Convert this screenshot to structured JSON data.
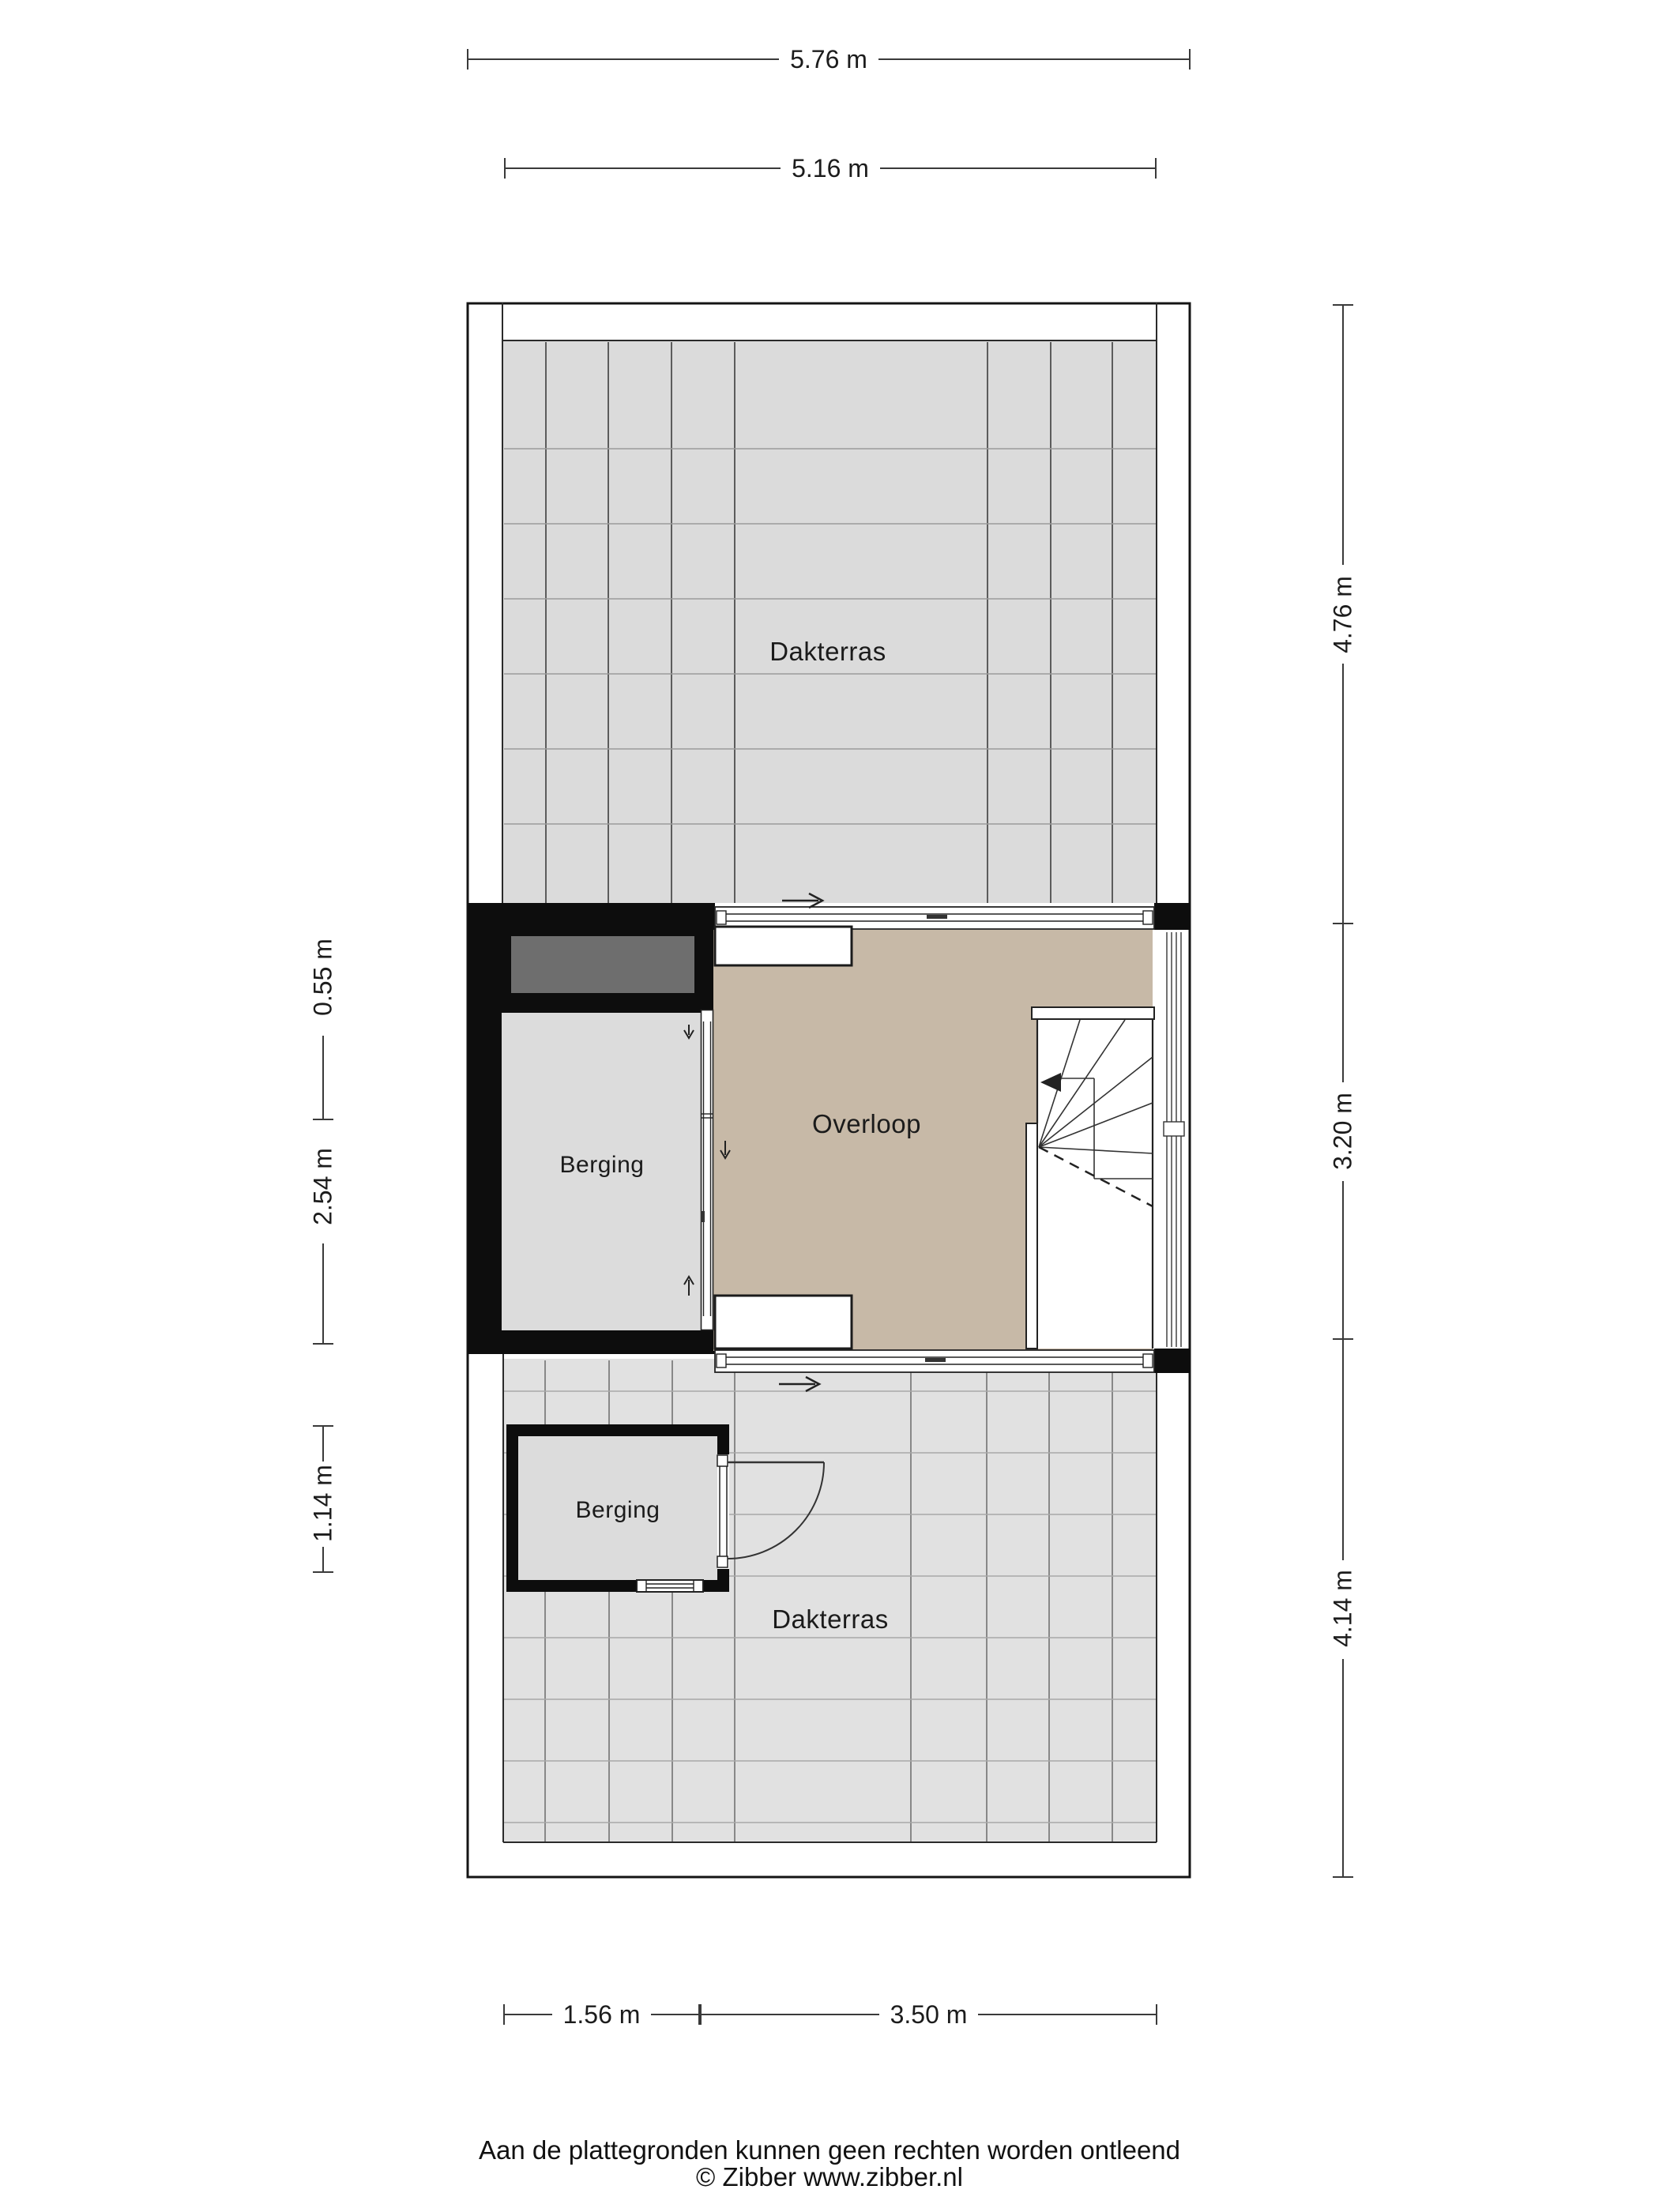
{
  "plan": {
    "type": "floorplan-second-floor",
    "rooms": {
      "dakterras_top": {
        "label": "Dakterras"
      },
      "berging_mid": {
        "label": "Berging"
      },
      "overloop": {
        "label": "Overloop"
      },
      "berging_low": {
        "label": "Berging"
      },
      "dakterras_low": {
        "label": "Dakterras"
      }
    },
    "dimensions": {
      "top_outer": "5.76 m",
      "top_inner": "5.16 m",
      "left_upper": "0.55 m",
      "left_mid": "2.54 m",
      "left_lower": "1.14 m",
      "right_upper": "4.76 m",
      "right_mid": "3.20 m",
      "right_lower": "4.14 m",
      "bottom_left": "1.56 m",
      "bottom_right": "3.50 m"
    },
    "colors": {
      "wall": "#0d0d0d",
      "line": "#2a2a2a",
      "tile_floor_upper": "#dbdbdb",
      "tile_floor_lower": "#e1e1e1",
      "tile_line_dark": "#3c3c3c",
      "tile_line_light": "#9b9b9b",
      "landing_floor": "#c7b9a7",
      "storage_floor": "#dcdcdc",
      "shaft_gray": "#6e6e6e"
    },
    "icons": {
      "door_swing": "quarter-arc-door",
      "sliding_door_arrows": "right-arrow",
      "stair_direction": "left-filled-arrow"
    }
  },
  "footer": {
    "disclaimer": "Aan de plattegronden kunnen geen rechten worden ontleend",
    "credit": "© Zibber www.zibber.nl"
  }
}
